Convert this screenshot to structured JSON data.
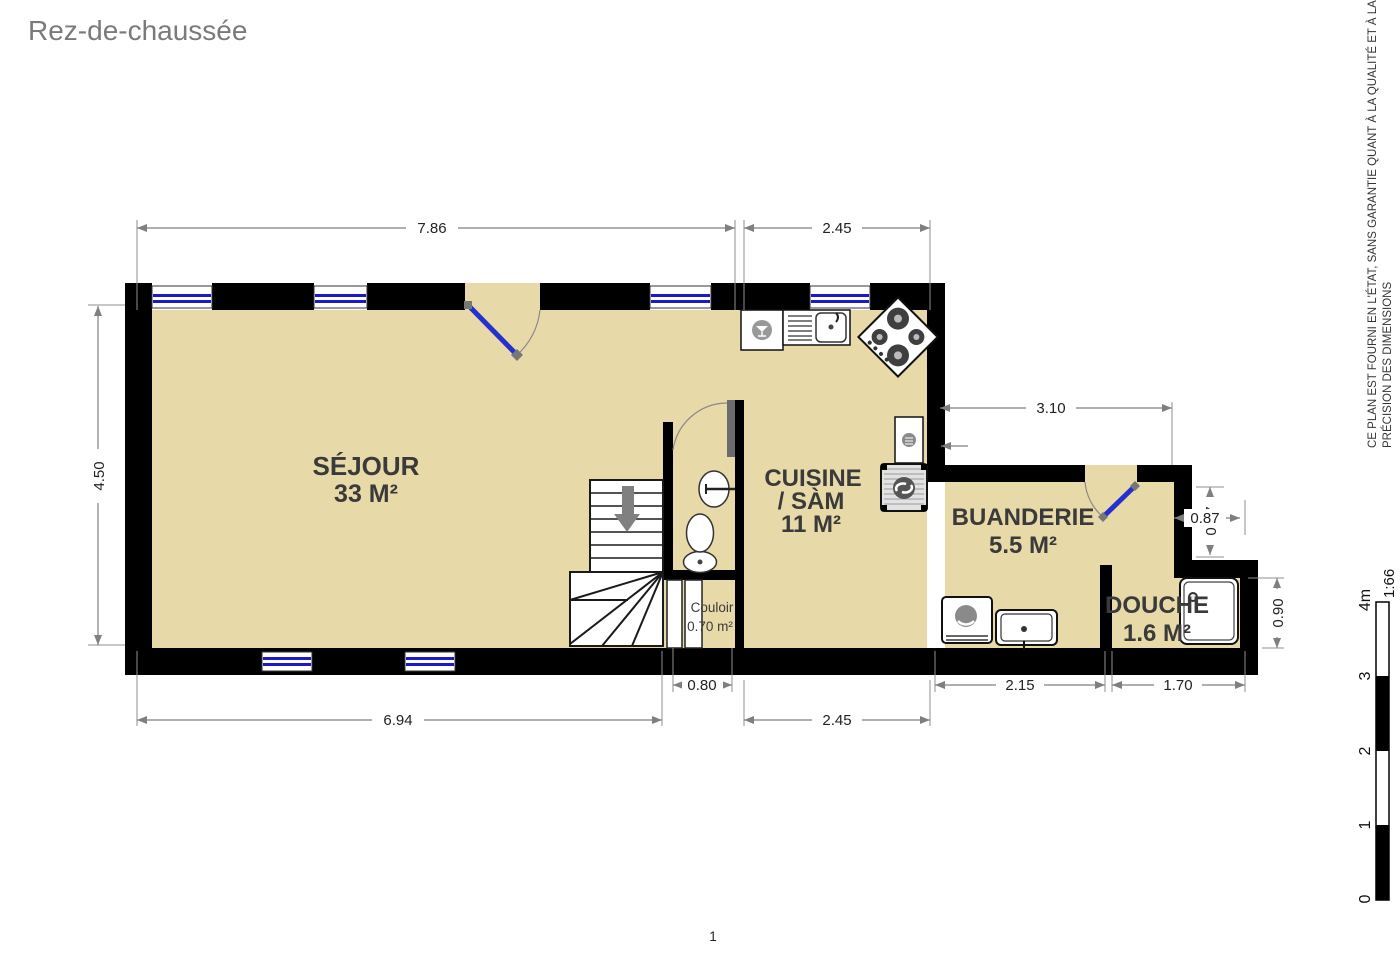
{
  "page": {
    "title": "Rez-de-chaussée",
    "page_number": "1"
  },
  "disclaimer": {
    "line1": "CE PLAN EST FOURNI EN L'ÉTAT, SANS GARANTIE QUANT À LA QUALITÉ ET À LA",
    "line2": "PRÉCISION DES DIMENSIONS"
  },
  "scale_bar": {
    "tick_0": "0",
    "tick_1": "1",
    "tick_2": "2",
    "tick_3": "3",
    "tick_4": "4m",
    "ratio": "1:66"
  },
  "rooms": {
    "sejour": {
      "name": "SÉJOUR",
      "area": "33 M²"
    },
    "cuisine": {
      "name": "CUISINE",
      "name_line2": "/ SÀM",
      "area": "11 M²"
    },
    "buanderie": {
      "name": "BUANDERIE",
      "area": "5.5 M²"
    },
    "douche": {
      "name": "DOUCHE",
      "area": "1.6 M²"
    },
    "couloir": {
      "name": "Couloir",
      "area": "0.70 m²"
    }
  },
  "dimensions_m": {
    "sejour_top_width": "7.86",
    "cuisine_top_width": "2.45",
    "buanderie_top_width": "3.10",
    "sejour_left_height": "4.50",
    "sejour_bottom_width": "6.94",
    "couloir_door_width": "0.80",
    "cuisine_bottom_width": "2.45",
    "buanderie_bottom_width": "2.15",
    "douche_bottom_width": "1.70",
    "douche_right_height": "0.90",
    "niche_width": "0.87",
    "niche_height": "0.97"
  },
  "colors": {
    "floor": "#e8d9a8",
    "wall": "#000000",
    "window_glass": "#1a1acc",
    "door_leaf": "#2430cf",
    "dimension_line": "#7f7f7f",
    "room_label": "#3a3a3a",
    "title": "#7a7a7a"
  }
}
